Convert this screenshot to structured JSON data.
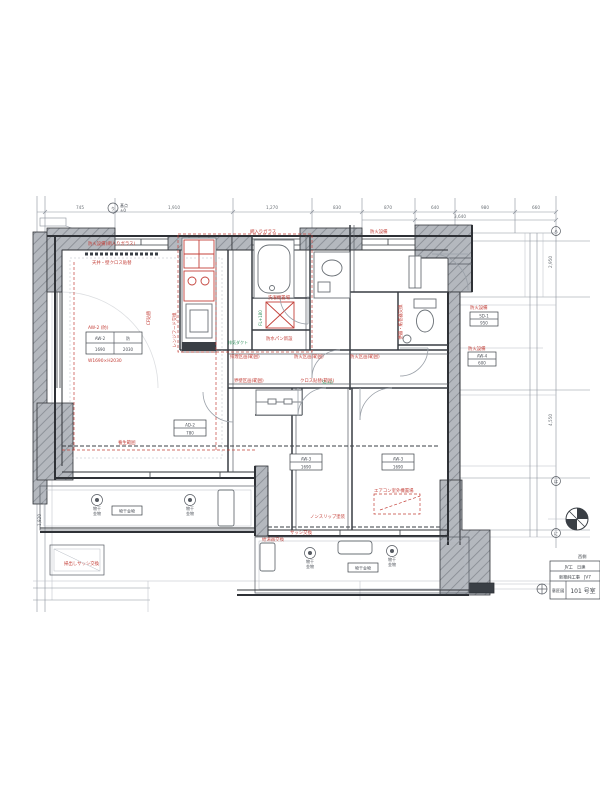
{
  "colors": {
    "wall": "#2e3136",
    "line": "#8b919b",
    "red": "#c4413a",
    "green": "#2f8f5b",
    "gray_fill": "#b4b8be"
  },
  "grid_mark": {
    "bubble": "り",
    "note1": "基点",
    "note2": "±0"
  },
  "bubbles": {
    "right1": "ろ",
    "right2": "は",
    "right3": "に"
  },
  "dims": {
    "top": [
      "745",
      "1,910",
      "1,270",
      "830",
      "870",
      "640",
      "980",
      "660"
    ],
    "top2": "3,640",
    "left": [
      "6,370",
      "1,820"
    ],
    "right": [
      "2,950",
      "4,550"
    ]
  },
  "red": [
    "防火設備(網入りガラス)",
    "レンジフード交換",
    "洗濯機置場",
    "排煙区画(範囲)",
    "防火区画(範囲)",
    "防火区画(範囲)",
    "界壁区画(範囲)",
    "クロス貼替(範囲)",
    "便器・紙巻器交換",
    "防火設備",
    "防火設備",
    "エアコン室外機置場",
    "ノンスリップ塗装",
    "天井・壁クロス貼替",
    "CF貼替",
    "AW-2 (防)",
    "W1690×H2030",
    "網入りガラス",
    "防火設備",
    "給湯器交換",
    "掃出しサッシ交換",
    "サッシ交換",
    "養生範囲",
    "防水パン新設"
  ],
  "green": [
    "FL+180",
    "SL±0",
    "排気ダクト"
  ],
  "tags": {
    "left_a": "AW-2",
    "left_b": "防",
    "left_c": "1690",
    "left_d": "2030",
    "t1a": "AD-2",
    "t1b": "780",
    "t2a": "AW-3",
    "t2b": "1690",
    "t3a": "AW-3",
    "t3b": "1690",
    "t4a": "SD-1",
    "t4b": "950",
    "t5a": "AW-4",
    "t5b": "600"
  },
  "balcony": {
    "label1": "物干金物",
    "label2": "物干金物",
    "c1": "物干",
    "c2": "金物"
  },
  "title_block": {
    "corner": "西側",
    "row1": "JV工　日建",
    "row2": "新築純工事　JV7",
    "cell": "意匠図",
    "room": "101 号室"
  }
}
